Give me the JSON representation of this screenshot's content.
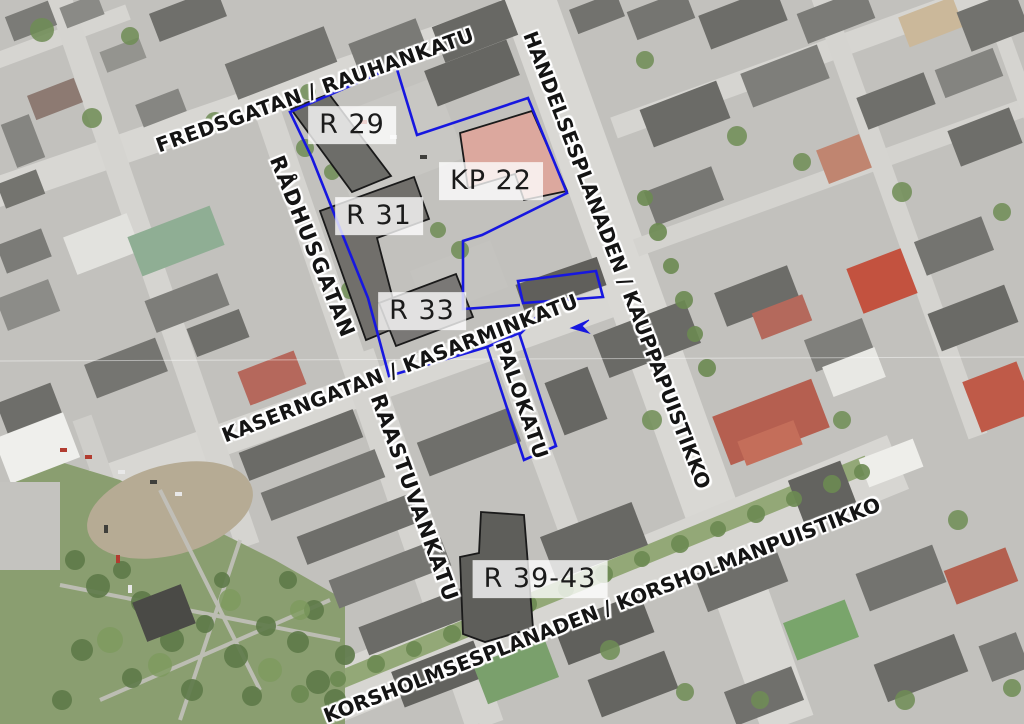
{
  "map": {
    "description": "Aerial photo planning map with block boundary annotations",
    "street_labels": {
      "fredsgatan": "FREDSGATAN / RAUHANKATU",
      "radhusgatan": "RÅDHUSGATAN",
      "handelsesplanaden": "HANDELSESPLANADEN / KAUPPAPUISTIKKO",
      "kaserngatan": "KASERNGATAN / KASARMINKATU",
      "palokatu": "PALOKATU",
      "raastuvankatu": "RAASTUVANKATU",
      "korsholmsesplanaden": "KORSHOLMSESPLANADEN / KORSHOLMANPUISTIKKO"
    },
    "block_labels": {
      "r29": "R 29",
      "kp22": "KP 22",
      "r31": "R 31",
      "r33": "R 33",
      "r39_43": "R 39-43"
    },
    "annotations": {
      "boundary_color": "#1717e0",
      "outline_color": "#1a1a1a",
      "blue_paths": [
        {
          "name": "block-boundary-west",
          "d": "M396,66 L290,112 L312,158 L341,231 L368,298 L389,376 L487,347"
        },
        {
          "name": "block-boundary-east",
          "d": "M396,66 L417,135 L528,98 L567,193 L482,235 L463,241 L463,309 L520,305"
        },
        {
          "name": "kp22-sub-area-rect",
          "d": "M518,281 L596,271 L603,297 L523,303 Z"
        },
        {
          "name": "palokatu-boundary-rect",
          "d": "M487,347 L519,333 L556,446 L524,460 Z"
        },
        {
          "name": "boundary-connector",
          "d": "M551,302 L520,334"
        },
        {
          "name": "blue-arrow-marker",
          "d": "M589,320 L571,328 L589,333 L582,326 Z",
          "filled": true
        }
      ],
      "outlined_buildings": [
        {
          "name": "building-r29",
          "d": "M291,109 L329,94 L391,176 L352,192 Z",
          "fill": "#6d6d69"
        },
        {
          "name": "building-r31",
          "d": "M320,211 L414,177 L429,219 L377,238 L400,326 L366,340 L335,253 Z",
          "fill": "#716f6b"
        },
        {
          "name": "building-r33",
          "d": "M379,303 L456,274 L473,317 L396,346 Z",
          "fill": "#7a7876"
        },
        {
          "name": "building-r39-43",
          "d": "M481,512 L524,515 L533,628 L485,642 L463,634 L460,557 L479,553 Z",
          "fill": "#5e5e5a"
        },
        {
          "name": "building-kp22",
          "d": "M460,133 L532,111 L567,191 L524,200 L515,174 L468,188 Z",
          "fill": "#dca89e"
        }
      ]
    }
  }
}
